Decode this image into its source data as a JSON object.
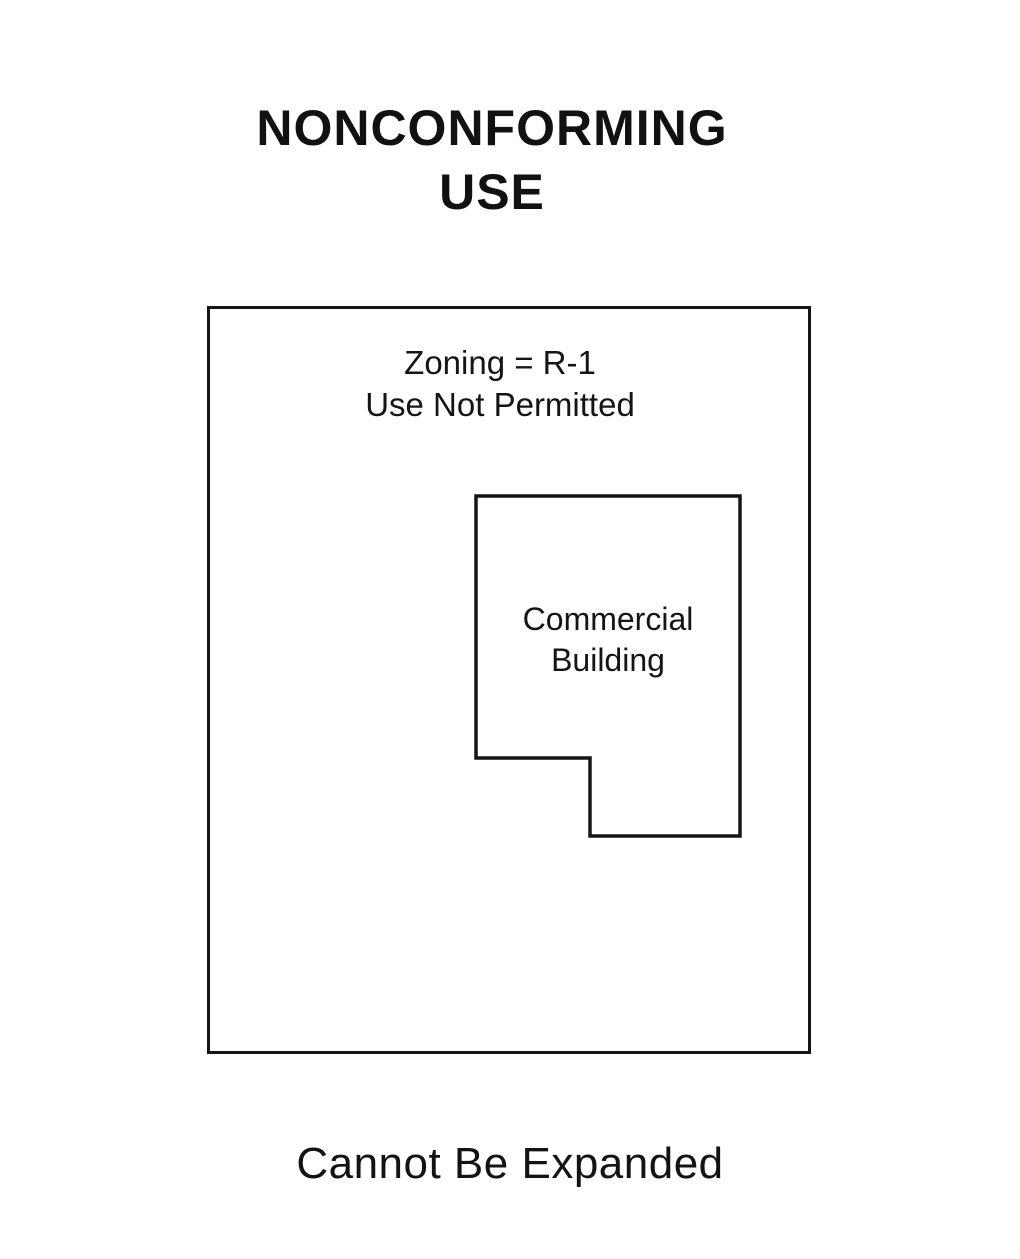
{
  "title": {
    "line1": "NONCONFORMING",
    "line2": "USE"
  },
  "lot": {
    "zoning_line1": "Zoning = R-1",
    "zoning_line2": "Use Not Permitted"
  },
  "building": {
    "label_line1": "Commercial",
    "label_line2": "Building"
  },
  "caption": "Cannot Be Expanded",
  "colors": {
    "ink": "#141414",
    "background": "#ffffff"
  },
  "diagram": {
    "lot_rect": {
      "x": 207,
      "y": 306,
      "width": 604,
      "height": 748
    },
    "building_polygon_points": "266,187 530,187 530,527 380,527 380,449 266,449"
  }
}
